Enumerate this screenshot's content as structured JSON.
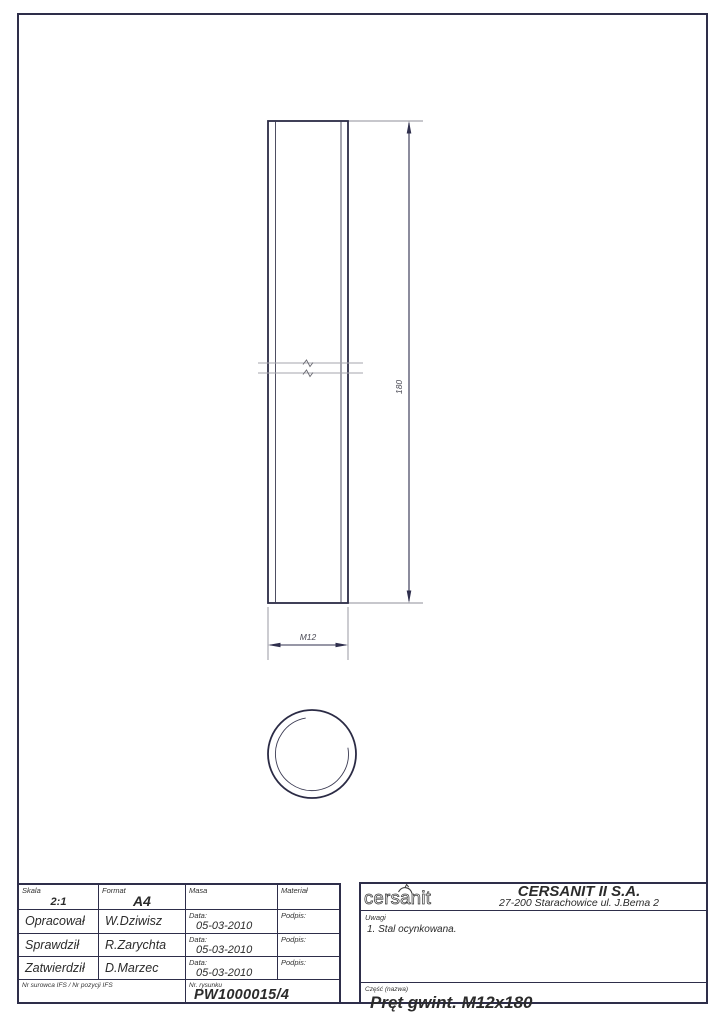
{
  "drawing": {
    "length_dim": "180",
    "thread_dim": "M12"
  },
  "title_block": {
    "skala": {
      "label": "Skala",
      "value": "2:1"
    },
    "format": {
      "label": "Format",
      "value": "A4"
    },
    "masa": {
      "label": "Masa",
      "value": ""
    },
    "material": {
      "label": "Materiał",
      "value": ""
    },
    "rows": [
      {
        "role": "Opracował",
        "name": "W.Dziwisz",
        "date_label": "Data:",
        "date": "05-03-2010",
        "sign_label": "Podpis:"
      },
      {
        "role": "Sprawdził",
        "name": "R.Zarychta",
        "date_label": "Data:",
        "date": "05-03-2010",
        "sign_label": "Podpis:"
      },
      {
        "role": "Zatwierdził",
        "name": "D.Marzec",
        "date_label": "Data:",
        "date": "05-03-2010",
        "sign_label": "Podpis:"
      }
    ],
    "nr_surowca_label": "Nr surowca IFS / Nr pozycji IFS",
    "drawing_number": {
      "label": "Nr. rysunku",
      "value": "PW1000015/4"
    }
  },
  "company": {
    "logo": "cersanit",
    "name": "CERSANIT II S.A.",
    "address": "27-200 Starachowice ul. J.Bema 2"
  },
  "notes": {
    "label": "Uwagi",
    "items": [
      "1. Stal ocynkowana."
    ]
  },
  "part": {
    "label": "Część (nazwa)",
    "value": "Pręt gwint. M12x180"
  }
}
